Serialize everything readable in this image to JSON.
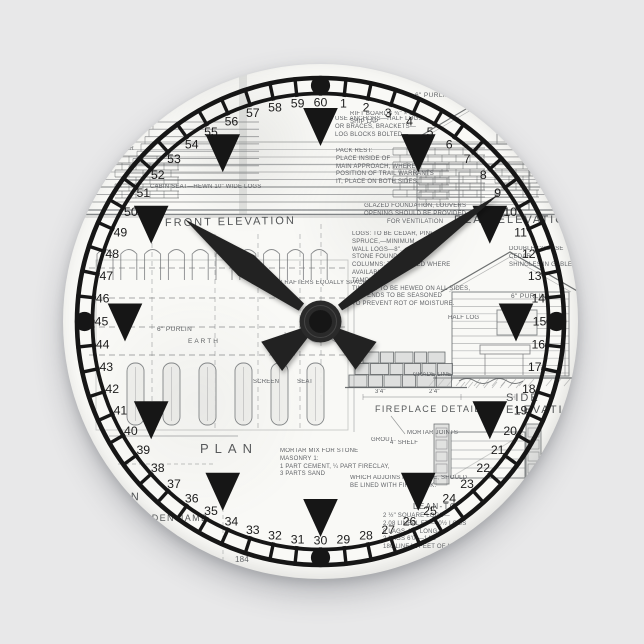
{
  "scene": {
    "background_color": "#e8e8e9"
  },
  "clock": {
    "face_color": "#f9f9f6",
    "ink_color": "#161616",
    "hand_color": "#242424",
    "displayed_time": "10:09",
    "hands": {
      "hour_angle_deg": 307,
      "minute_angle_deg": 54.5
    },
    "minute_numbers": [
      1,
      2,
      3,
      4,
      5,
      6,
      7,
      8,
      9,
      10,
      11,
      12,
      13,
      14,
      15,
      16,
      17,
      18,
      19,
      20,
      21,
      22,
      23,
      24,
      25,
      26,
      27,
      28,
      29,
      30,
      31,
      32,
      33,
      34,
      35,
      36,
      37,
      38,
      39,
      40,
      41,
      42,
      43,
      44,
      45,
      46,
      47,
      48,
      49,
      50,
      51,
      52,
      53,
      54,
      55,
      56,
      57,
      58,
      59,
      60
    ],
    "hour_marker_count": 12,
    "cardinal_dots": [
      "12",
      "3",
      "6",
      "9"
    ]
  },
  "face": {
    "titles": {
      "front_elevation": "FRONT ELEVATION",
      "rear_elevation": "REAR ELEVATION",
      "side_elevation": "SIDE ELEVATION",
      "plan": "PLAN",
      "plan_partial": "PLAN",
      "fireplace_detail": "FIREPLACE DETAIL",
      "lean_to": "LEAN-TO",
      "jamb": "WOODEN JAMB"
    },
    "labels": {
      "purlin_top": "6\" PURLIN",
      "purlin_left": "6\" PURLIN",
      "purlin_right": "6\" PURLIN",
      "earth": "EARTH",
      "rafters": "6\" TIMBER RAFTERS EQUALLY SPACED",
      "rafter_left": "6\" RAFTER",
      "half_log": "HALF LOG",
      "rift_note": "RIFT BOARDS ¾\" × 8\"\nSHIP LAP",
      "cedar_shingles": "DOUBLE COURSE CEDAR\nSHINGLES IN GABLE",
      "mortar_joints": "MORTAR JOINTS",
      "grout": "GROUT",
      "shelf": "4\" SHELF",
      "grade_line": "GRADE LINE",
      "dim1": "3'4\"",
      "dim2": "2'4\"",
      "screen": "SCREEN",
      "seat": "SEAT",
      "sheet_number": "184",
      "seat_note": "CABIN SEAT—HEWN 10\" WIDE LOGS"
    },
    "notes": {
      "anchors_note": "USE ANCHORS—HALF LOGS\nOR BRACES, BRACKETS—\nLOG BLOCKS BOLTED—",
      "pack_note": "PACK REST:\nPLACE INSIDE OF\nMAIN APPROACH, WHERE\nPOSITION OF TRAIL WARRANTS\nIT, PLACE ON BOTH SIDES.",
      "vent_note": "GLAZED FOUNDATION, LOUVERS\nOPENING SHOULD BE PROVIDED\nFOR VENTILATION",
      "logs_note": "LOGS: TO BE CEDAR, PINE OR\nSPRUCE,—MINIMUM\nWALL LOGS—8\".\nSTONE FOUNDATION\nCOLUMNS: TO BE USED WHERE\nAVAILABLE.\nTAMPED\nTIMBER: TO BE HEWED ON ALL SIDES,\nLOG ENDS TO BE SEASONED\nTO PREVENT ROT OF MOISTURE.",
      "masonry_note": "MORTAR MIX FOR STONE\nMASONRY 1:\n1 PART CEMENT, ¼ PART FIRECLAY,\n3 PARTS SAND",
      "fireplace_note": "WHICH ADJOINS FIREPLACE, SHOULD\nBE LINED WITH FIRE BRICK.",
      "lean_to_specs": "2 ½\" SQUARE LOGS—\n2.08 LINEAL FT—40½ LOGS\n8 LAGS 4'6\" LONG—\n2 LAGS 6'0\"—14'6\"\n180 LINEAL FEET OF LOGS"
    }
  }
}
